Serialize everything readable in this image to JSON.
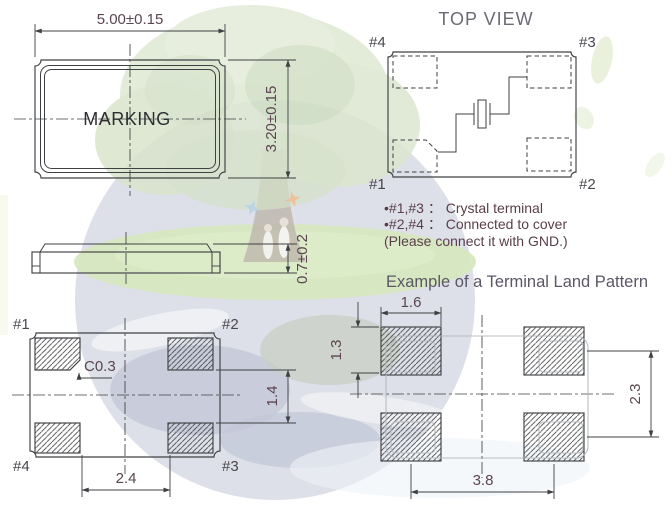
{
  "front_view": {
    "marking": "MARKING",
    "dim_width": "5.00±0.15",
    "dim_height": "3.20±0.15"
  },
  "side_view": {
    "dim_thickness": "0.7±0.2"
  },
  "top_view": {
    "title": "TOP VIEW",
    "pin_tl": "#4",
    "pin_tr": "#3",
    "pin_bl": "#1",
    "pin_br": "#2",
    "notes": [
      "•#1,#3 ： Crystal terminal",
      "•#2,#4 ： Connected to cover",
      "(Please connect it with GND.)"
    ]
  },
  "bottom_view": {
    "pin_tl": "#1",
    "pin_tr": "#2",
    "pin_bl": "#4",
    "pin_br": "#3",
    "chamfer": "C0.3",
    "dim_vertical_gap": "1.4",
    "dim_horizontal_gap": "2.4"
  },
  "land_pattern": {
    "title": "Example of a Terminal Land Pattern",
    "dim_pad_width": "1.6",
    "dim_pad_height": "1.3",
    "dim_vertical_pitch": "2.3",
    "dim_horizontal_pitch": "3.8"
  },
  "colors": {
    "line": "#3f4043",
    "dim-text": "#5a4550",
    "title-gray": "#6b6b75",
    "subtitle": "#5c5666",
    "notes-text": "#5a3f4b",
    "marking": "#2d2d32",
    "pin-label": "#4a474d",
    "ghost": "#b4b7ba",
    "foliage": "#c3d3ae",
    "foliage-dark": "#9fbd8a",
    "grass": "#b5d48c",
    "globe": "#b6bccf",
    "globe-dark": "#959dba",
    "trunk": "#8a7a6a"
  }
}
